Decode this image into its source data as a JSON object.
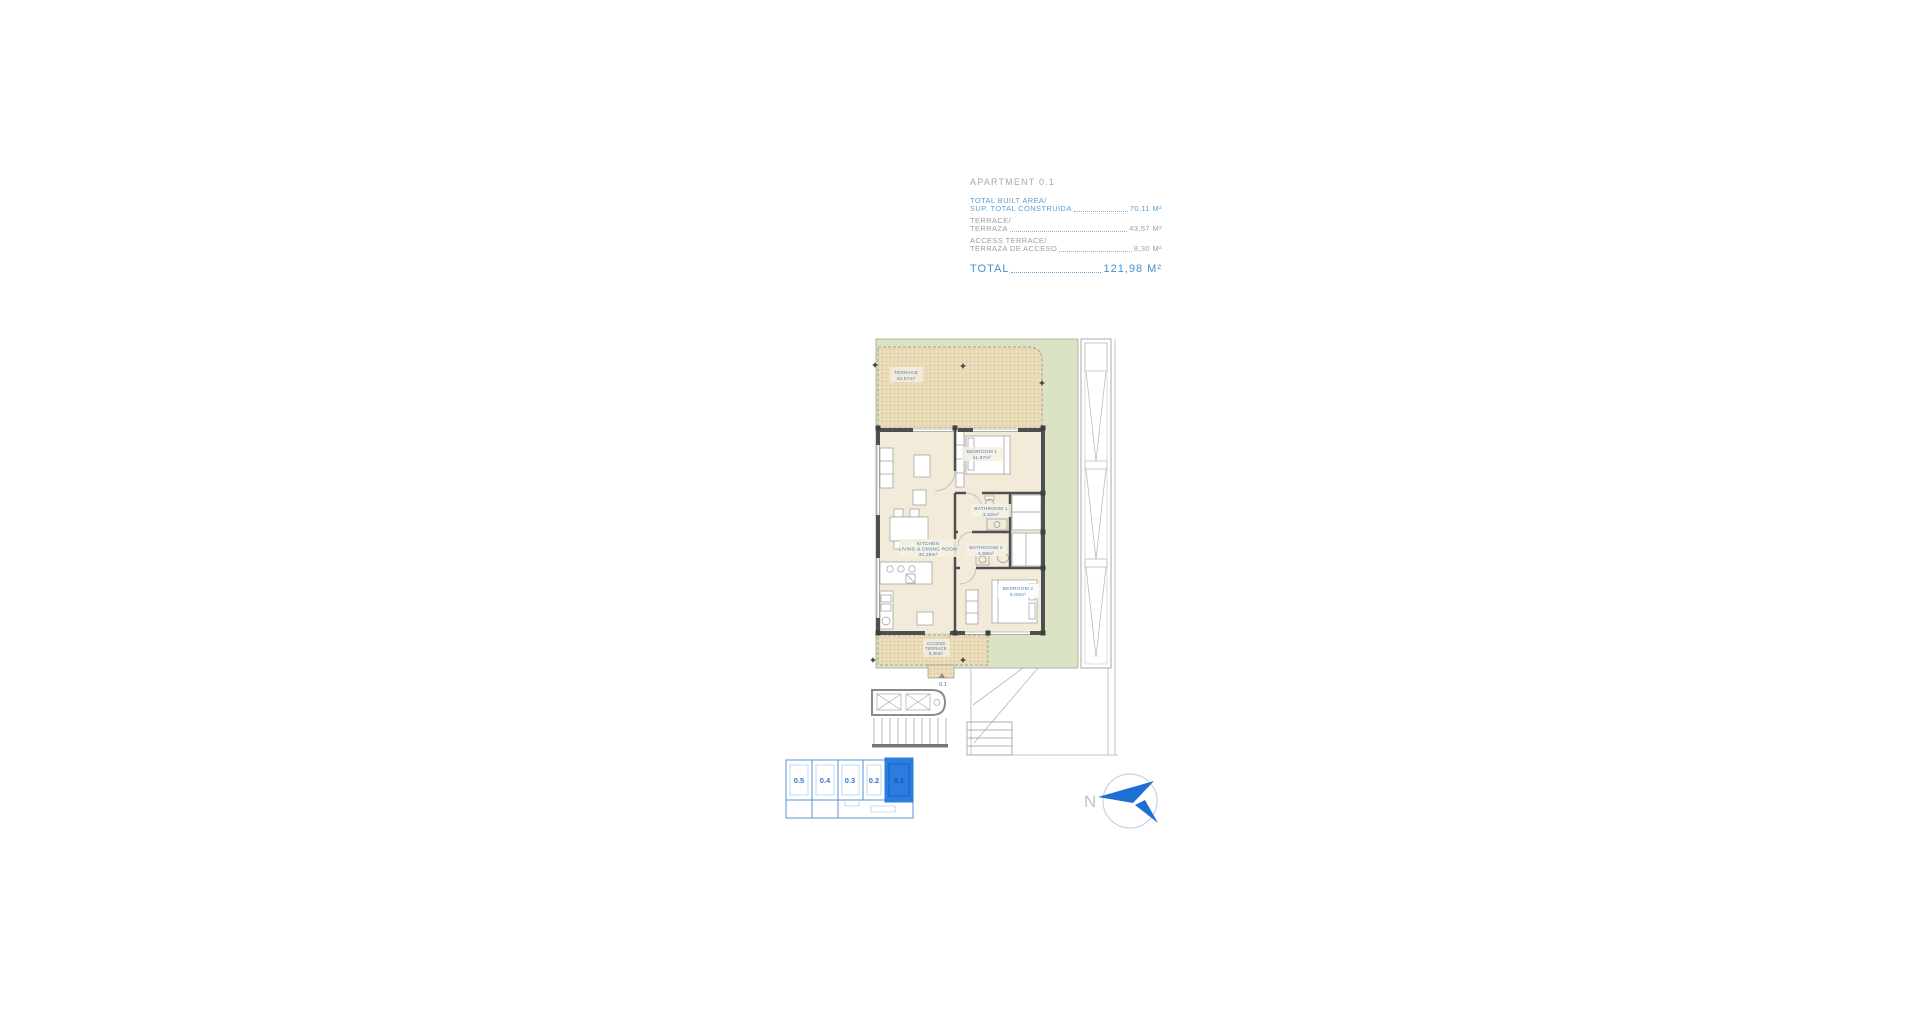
{
  "header": {
    "title": "APARTMENT 0.1",
    "rows": [
      {
        "line1": "TOTAL BUILT AREA/",
        "line2": "SUP. TOTAL CONSTRUIDA",
        "value": "70,11 M²"
      },
      {
        "line1": "TERRACE/",
        "line2": "TERRAZA",
        "value": "43,57 M²"
      },
      {
        "line1": "ACCESS TERRACE/",
        "line2": "TERRAZA DE ACCESO",
        "value": "8,30 M²"
      }
    ],
    "total_label": "TOTAL",
    "total_value": "121,98 M²"
  },
  "plan": {
    "terrace": {
      "name": "TERRACE",
      "area": "43,57m²"
    },
    "bedroom1": {
      "name": "BEDROOM 1",
      "area": "11,87m²"
    },
    "bathroom1": {
      "name": "BATHROOM 1",
      "area": "3,52m²"
    },
    "bathroom2": {
      "name": "BATHROOM 2",
      "area": "4,58m²"
    },
    "kitchen": {
      "name1": "KITCHEN",
      "name2": "LIVING & DINING ROOM",
      "area": "30,29m²"
    },
    "bedroom2": {
      "name": "BEDROOM 2",
      "area": "9,00m²"
    },
    "access_terrace": {
      "name1": "ACCESS",
      "name2": "TERRACE",
      "area": "8,30m²"
    },
    "entry_marker": "0.1"
  },
  "keyplan": {
    "units": [
      "0.5",
      "0.4",
      "0.3",
      "0.2",
      "0.1"
    ],
    "selected": "0.1"
  },
  "compass": {
    "north_label": "N"
  },
  "colors": {
    "accent_blue": "#4596d2",
    "text_gray": "#98a1a7",
    "plan_green": "#dbe3c5",
    "terrace_tan": "#ecdfbe",
    "wall_gray": "#4f4f4f",
    "keyplan_blue": "#2b7de0"
  }
}
